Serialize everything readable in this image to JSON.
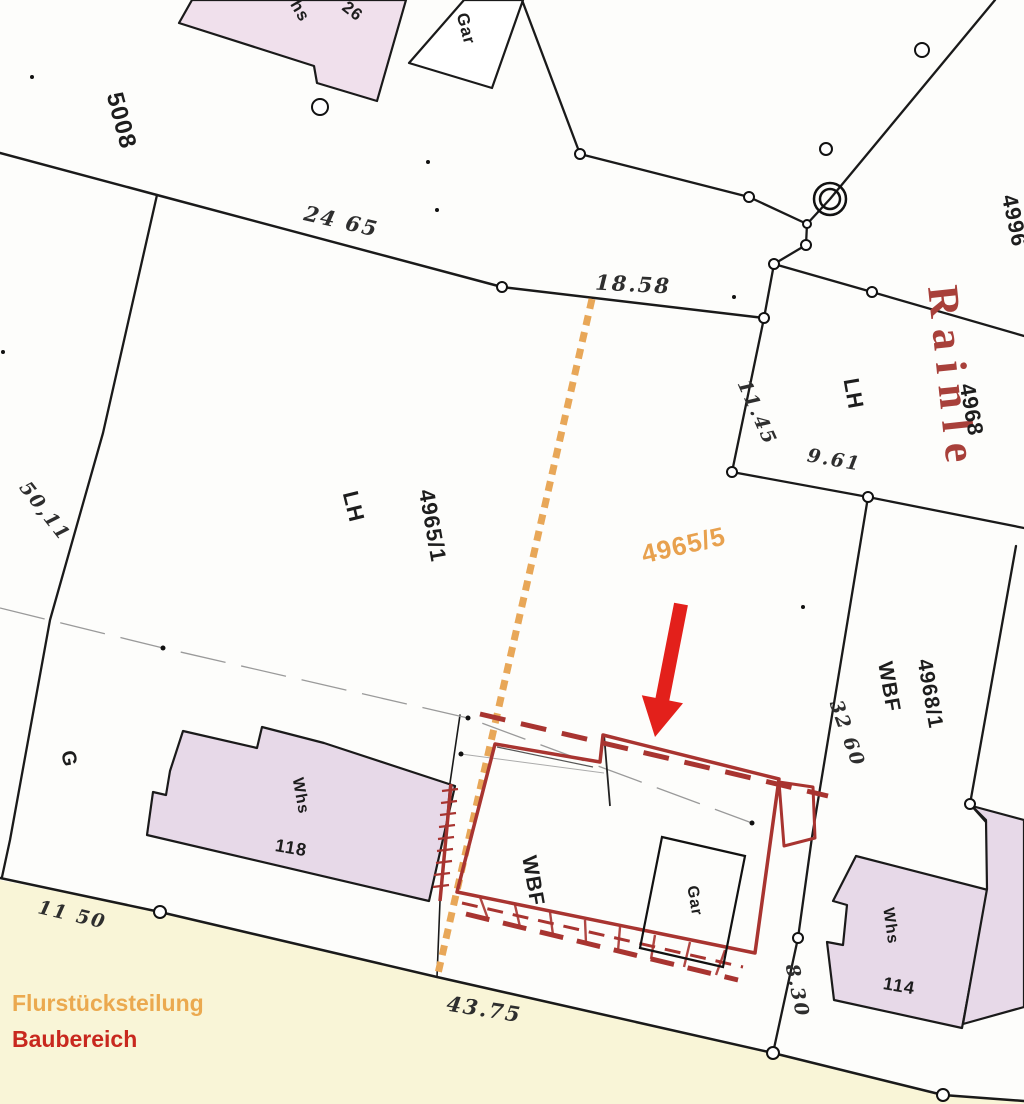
{
  "legend": {
    "division_label": "Flurstücksteilung",
    "build_area_label": "Baubereich"
  },
  "street": {
    "name": "Rainle"
  },
  "parcels": {
    "p5008": "5008",
    "p4996": "4996",
    "p4968": "4968",
    "p4965_1": "4965/1",
    "p4965_5": "4965/5",
    "p4968_1": "4968/1"
  },
  "land_use": {
    "lh_main": "LH",
    "lh_east": "LH",
    "wbf_east": "WBF",
    "wbf_bau": "WBF",
    "g": "G"
  },
  "buildings": {
    "whs_north": "Whs",
    "no_26": "26",
    "gar_north": "Gar",
    "whs_118": "Whs",
    "no_118": "118",
    "gar_bau": "Gar",
    "whs_114": "Whs",
    "no_114": "114"
  },
  "measurements": {
    "m24_65": "24 65",
    "m18_58": "18.58",
    "m11_45": "11.45",
    "m9_61": "9.61",
    "m50_11": "50,11",
    "m32_60": "32 60",
    "m8_30": "8.30",
    "m43_75": "43.75",
    "m11_50": "11 50"
  },
  "colors": {
    "division_line": "#E8A758",
    "build_area": "#A83430",
    "arrow": "#E3201B",
    "legend_orange": "#EBA94F",
    "legend_red": "#C8281E",
    "building_fill": "#E7D9E8",
    "street_tint": "#F7F2CE",
    "boundary": "#1A1A1A"
  }
}
